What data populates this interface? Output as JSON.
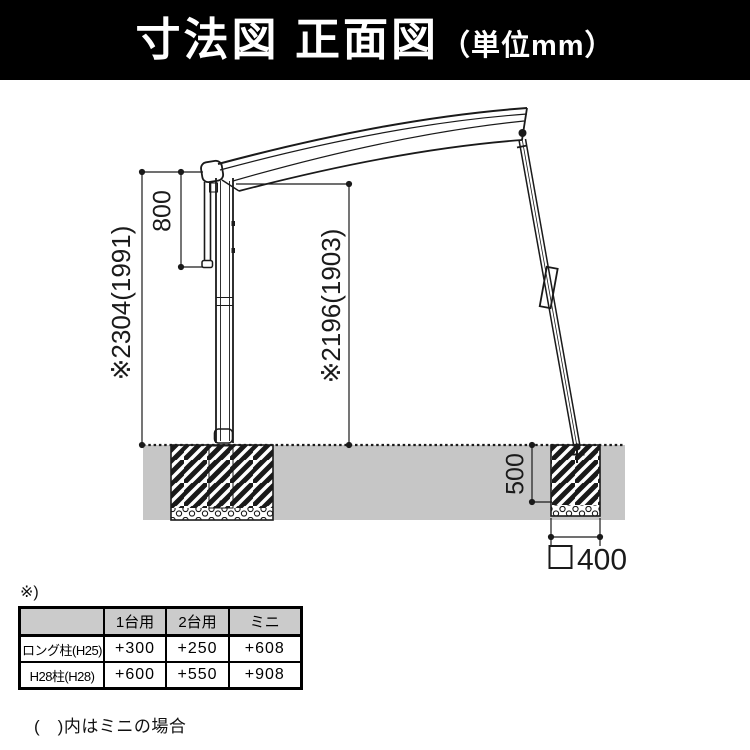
{
  "header": {
    "title_main": "寸法図 正面図",
    "title_unit": "（単位mm）",
    "bg_color": "#000000",
    "text_color": "#ffffff"
  },
  "diagram": {
    "labels": {
      "overall_height": "※2304(1991)",
      "upper_section_height": "800",
      "clearance_height": "※2196(1903)",
      "foundation_depth": "500",
      "foundation_width": "400"
    },
    "colors": {
      "ground": "#c6c6c6",
      "line": "#1a1a1a"
    }
  },
  "table": {
    "note_mark": "※)",
    "col_headers": [
      "1台用",
      "2台用",
      "ミニ"
    ],
    "rows": [
      {
        "label": "ロング柱(H25)",
        "values": [
          "+300",
          "+250",
          "+608"
        ]
      },
      {
        "label": "H28柱(H28)",
        "values": [
          "+600",
          "+550",
          "+908"
        ]
      }
    ],
    "header_bg": "#cbcbcb"
  },
  "footnote": "(　)内はミニの場合"
}
